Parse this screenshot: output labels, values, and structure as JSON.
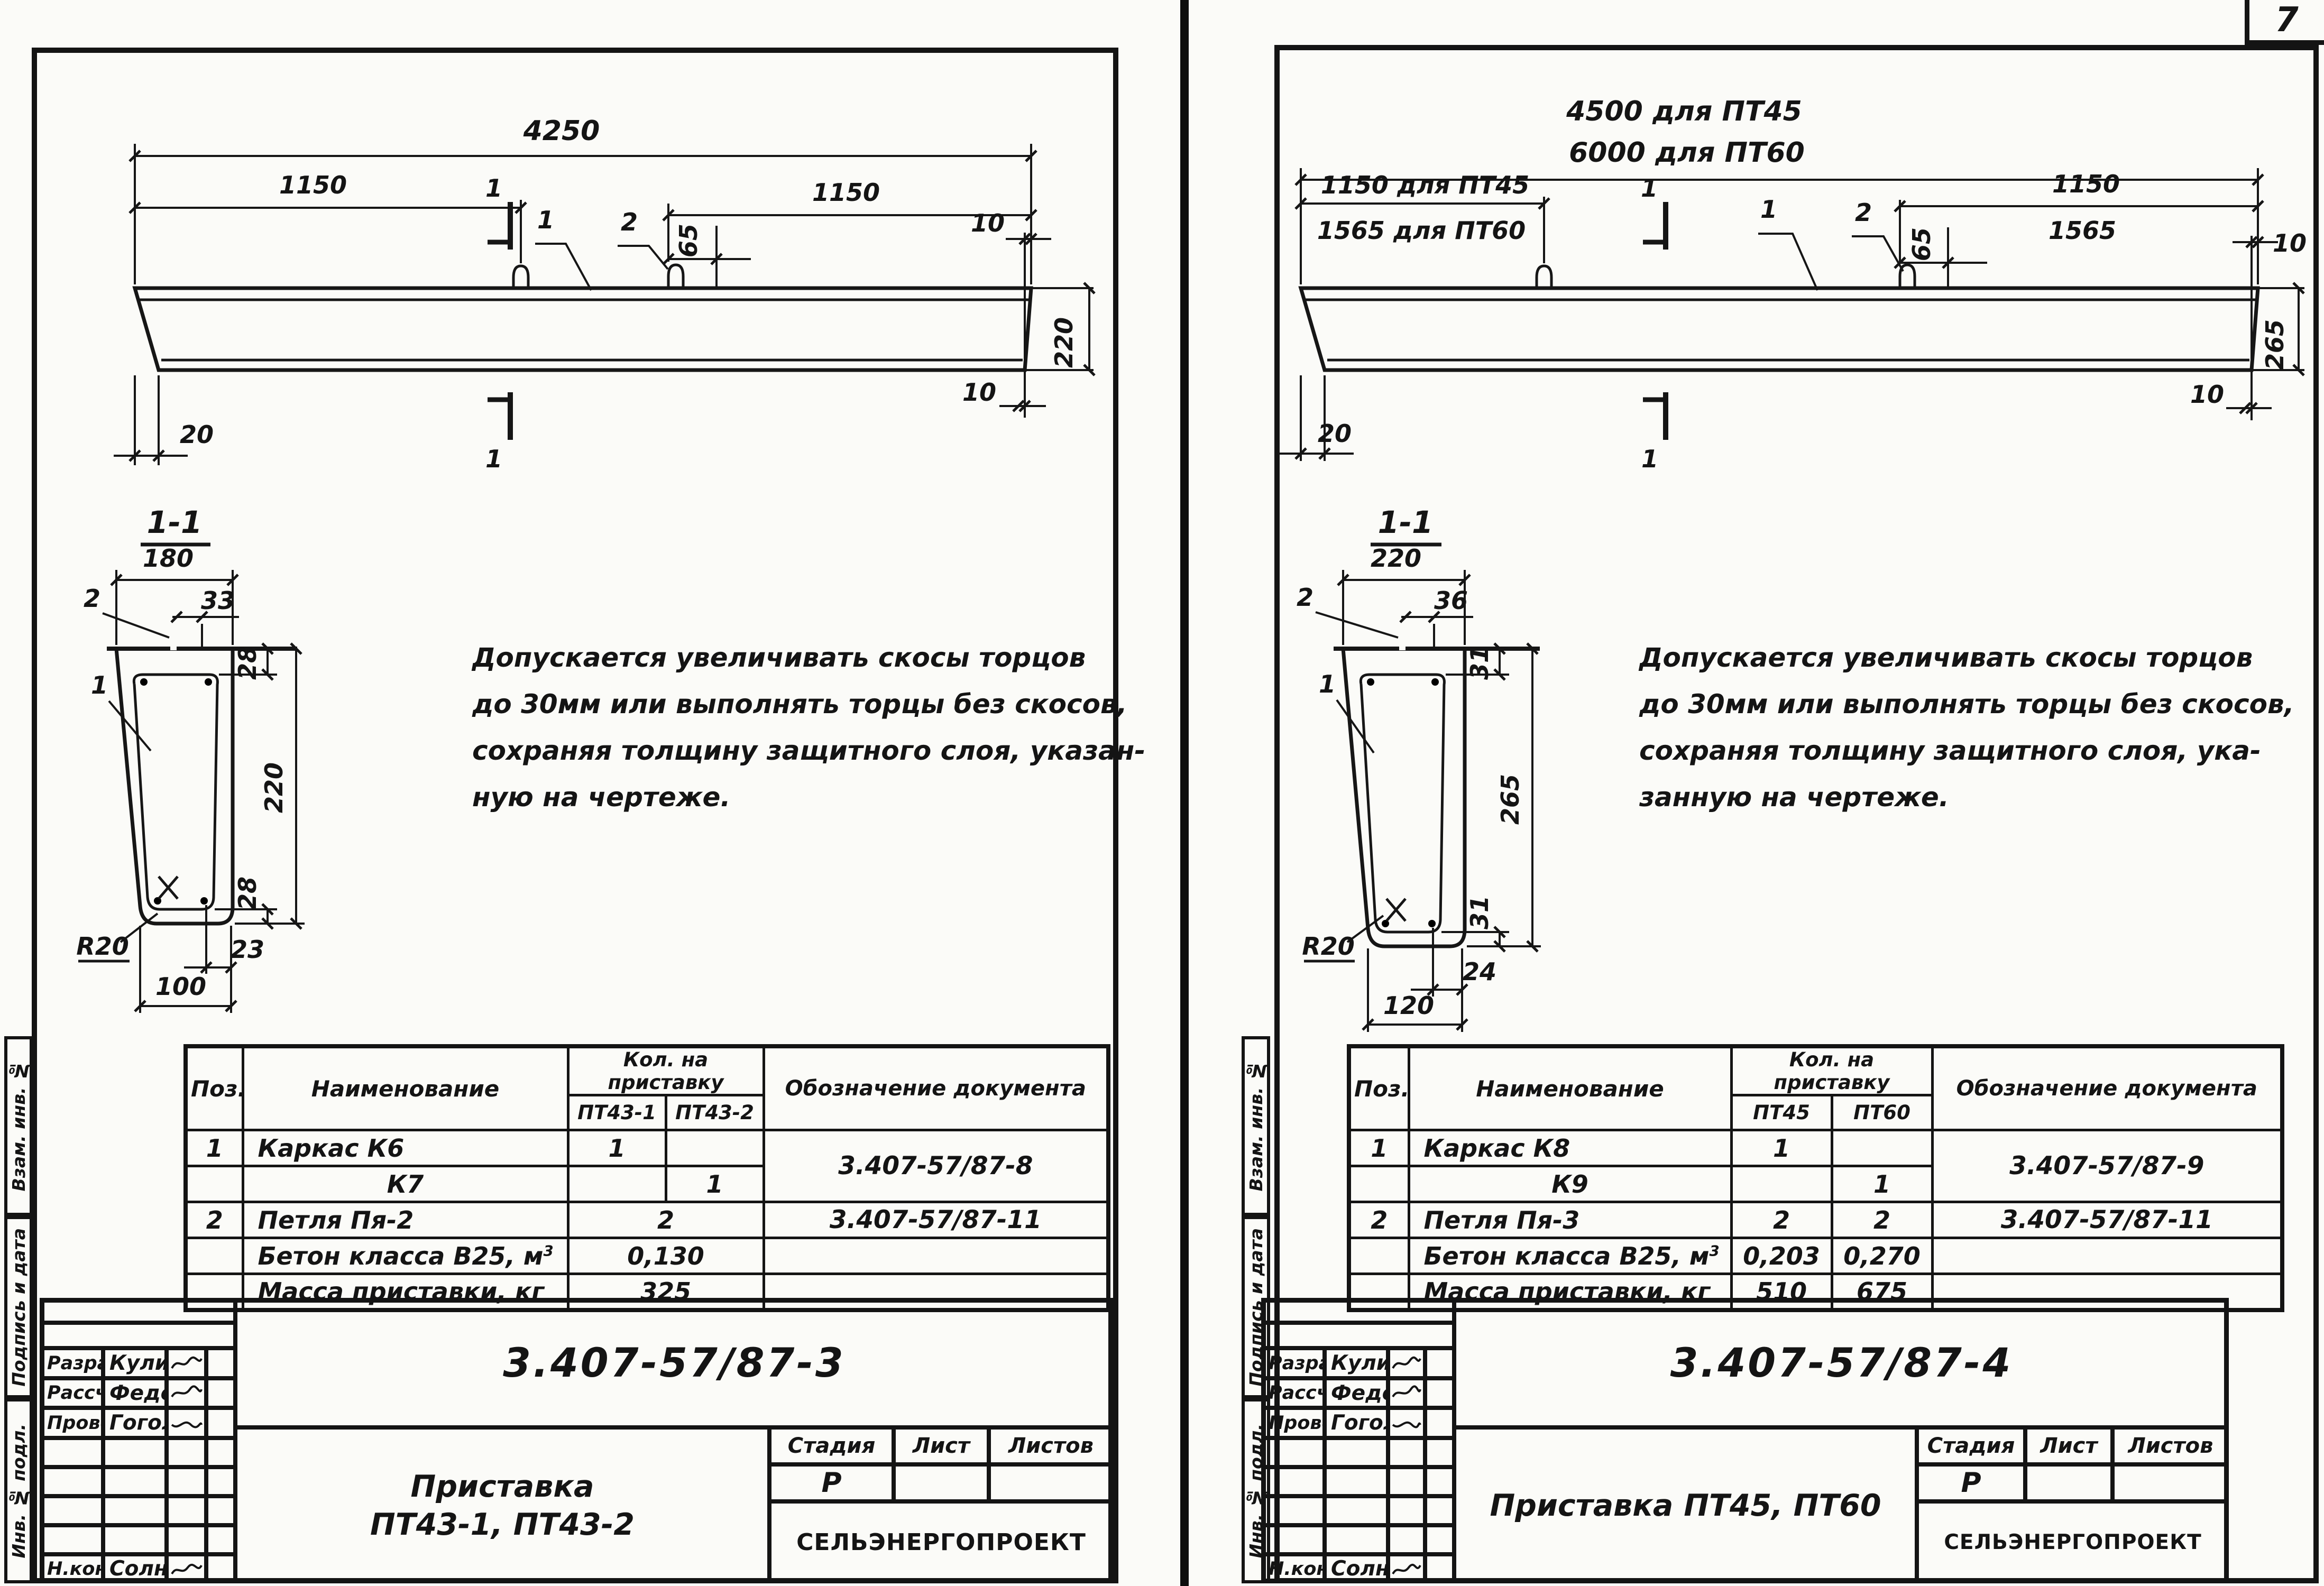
{
  "page_number": "7",
  "left": {
    "side_labels": [
      "Взам. инв. №",
      "Подпись и дата",
      "Инв. № подл."
    ],
    "beam": {
      "dim_total": "4250",
      "dim_left": "1150",
      "dim_right": "1150",
      "dim_loop_offset": "65",
      "dim_end_top": "10",
      "dim_height": "220",
      "dim_end_bottom": "10",
      "dim_bevel": "20",
      "mark_top": "1",
      "mark_bottom": "1",
      "callout_body": "1",
      "callout_loop": "2"
    },
    "section": {
      "title": "1-1",
      "dim_top_width": "180",
      "dim_pin": "33",
      "dim_cover_top": "28",
      "dim_height": "220",
      "dim_cover_bottom": "28",
      "dim_corner": "23",
      "dim_bottom_width": "100",
      "radius": "R20",
      "callout_cage": "1",
      "callout_pin": "2"
    },
    "note": [
      "Допускается увеличивать скосы торцов",
      "до 30мм или выполнять торцы без скосов,",
      "сохраняя толщину защитного слоя, указан-",
      "ную на чертеже."
    ],
    "table": {
      "h_pos": "Поз.",
      "h_name": "Наименование",
      "h_qty": "Кол. на приставку",
      "h_col1": "ПТ43-1",
      "h_col2": "ПТ43-2",
      "h_doc": "Обозначение документа",
      "rows": [
        {
          "pos": "1",
          "name": "Каркас К6",
          "q1": "1",
          "q2": "",
          "doc": "3.407-57/87-8"
        },
        {
          "pos": "",
          "name": "К7",
          "q1": "",
          "q2": "1"
        },
        {
          "pos": "2",
          "name": "Петля Пя-2",
          "q": "2",
          "doc": "3.407-57/87-11"
        },
        {
          "pos": "",
          "name": "Бетон класса В25, м",
          "name_sup": "3",
          "q": "0,130"
        },
        {
          "pos": "",
          "name": "Масса приставки, кг",
          "q": "325"
        }
      ]
    },
    "titleblock": {
      "r1_label": "Разраб.",
      "r1_name": "Куликова",
      "r2_label": "Рассчит.",
      "r2_name": "Федотова",
      "r3_label": "Провер.",
      "r3_name": "Гоголев",
      "r4_label": "Н.контр.",
      "r4_name": "Солнцева",
      "doc_number": "3.407-57/87-3",
      "title_line1": "Приставка",
      "title_line2": "ПТ43-1, ПТ43-2",
      "stage_label": "Стадия",
      "sheet_label": "Лист",
      "sheets_label": "Листов",
      "stage": "Р",
      "org": "СЕЛЬЭНЕРГОПРОЕКТ"
    }
  },
  "right": {
    "side_labels": [
      "Взам. инв. №",
      "Подпись и дата",
      "Инв. № подл."
    ],
    "beam": {
      "dim_total_1": "4500 для ПТ45",
      "dim_total_2": "6000 для ПТ60",
      "dim_left_1": "1150 для ПТ45",
      "dim_left_2": "1565 для ПТ60",
      "dim_right_1": "1150",
      "dim_right_2": "1565",
      "dim_loop_offset": "65",
      "dim_end_top": "10",
      "dim_height": "265",
      "dim_end_bottom": "10",
      "dim_bevel": "20",
      "mark_top": "1",
      "mark_bottom": "1",
      "callout_body": "1",
      "callout_loop": "2"
    },
    "section": {
      "title": "1-1",
      "dim_top_width": "220",
      "dim_pin": "36",
      "dim_cover_top": "31",
      "dim_height": "265",
      "dim_cover_bottom": "31",
      "dim_corner": "24",
      "dim_bottom_width": "120",
      "radius": "R20",
      "callout_cage": "1",
      "callout_pin": "2"
    },
    "note": [
      "Допускается увеличивать скосы торцов",
      "до 30мм или выполнять торцы без скосов,",
      "сохраняя толщину защитного слоя, ука-",
      "занную на чертеже."
    ],
    "table": {
      "h_pos": "Поз.",
      "h_name": "Наименование",
      "h_qty": "Кол. на приставку",
      "h_col1": "ПТ45",
      "h_col2": "ПТ60",
      "h_doc": "Обозначение документа",
      "rows": [
        {
          "pos": "1",
          "name": "Каркас К8",
          "q1": "1",
          "q2": "",
          "doc": "3.407-57/87-9"
        },
        {
          "pos": "",
          "name": "К9",
          "q1": "",
          "q2": "1"
        },
        {
          "pos": "2",
          "name": "Петля Пя-3",
          "q1": "2",
          "q2": "2",
          "doc": "3.407-57/87-11"
        },
        {
          "pos": "",
          "name": "Бетон класса В25, м",
          "name_sup": "3",
          "q1": "0,203",
          "q2": "0,270"
        },
        {
          "pos": "",
          "name": "Масса приставки, кг",
          "q1": "510",
          "q2": "675"
        }
      ]
    },
    "titleblock": {
      "r1_label": "Разраб.",
      "r1_name": "Куликова",
      "r2_label": "Рассчит.",
      "r2_name": "Федотова",
      "r3_label": "Провер.",
      "r3_name": "Гоголев",
      "r4_label": "Н.контр.",
      "r4_name": "Солнцева",
      "doc_number": "3.407-57/87-4",
      "title_line1": "Приставка ПТ45, ПТ60",
      "title_line2": "",
      "stage_label": "Стадия",
      "sheet_label": "Лист",
      "sheets_label": "Листов",
      "stage": "Р",
      "org": "СЕЛЬЭНЕРГОПРОЕКТ"
    }
  }
}
